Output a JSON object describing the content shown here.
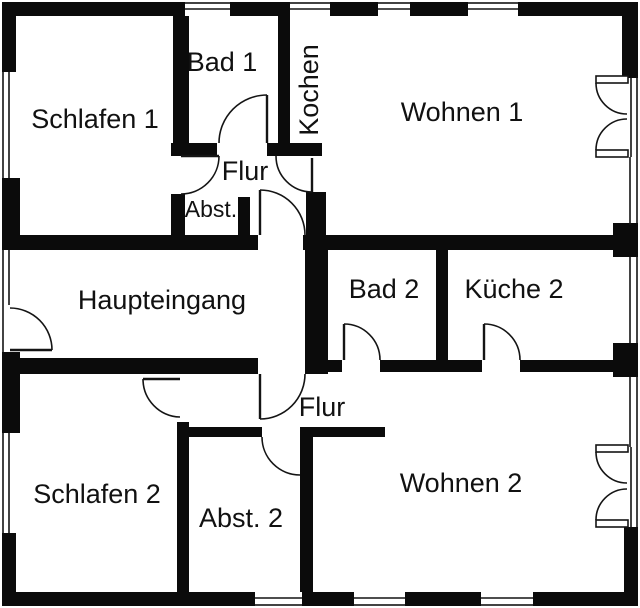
{
  "floor_plan": {
    "background_color": "#ffffff",
    "wall_color": "#0b0b0b",
    "line_color": "#141414",
    "rooms": {
      "schlafen1": "Schlafen 1",
      "bad1": "Bad 1",
      "kochen": "Kochen",
      "wohnen1": "Wohnen 1",
      "flur1": "Flur",
      "abst1": "Abst.",
      "haupteingang": "Haupteingang",
      "bad2": "Bad 2",
      "kueche2": "Küche 2",
      "flur2": "Flur",
      "schlafen2": "Schlafen 2",
      "abst2": "Abst. 2",
      "wohnen2": "Wohnen 2"
    }
  }
}
